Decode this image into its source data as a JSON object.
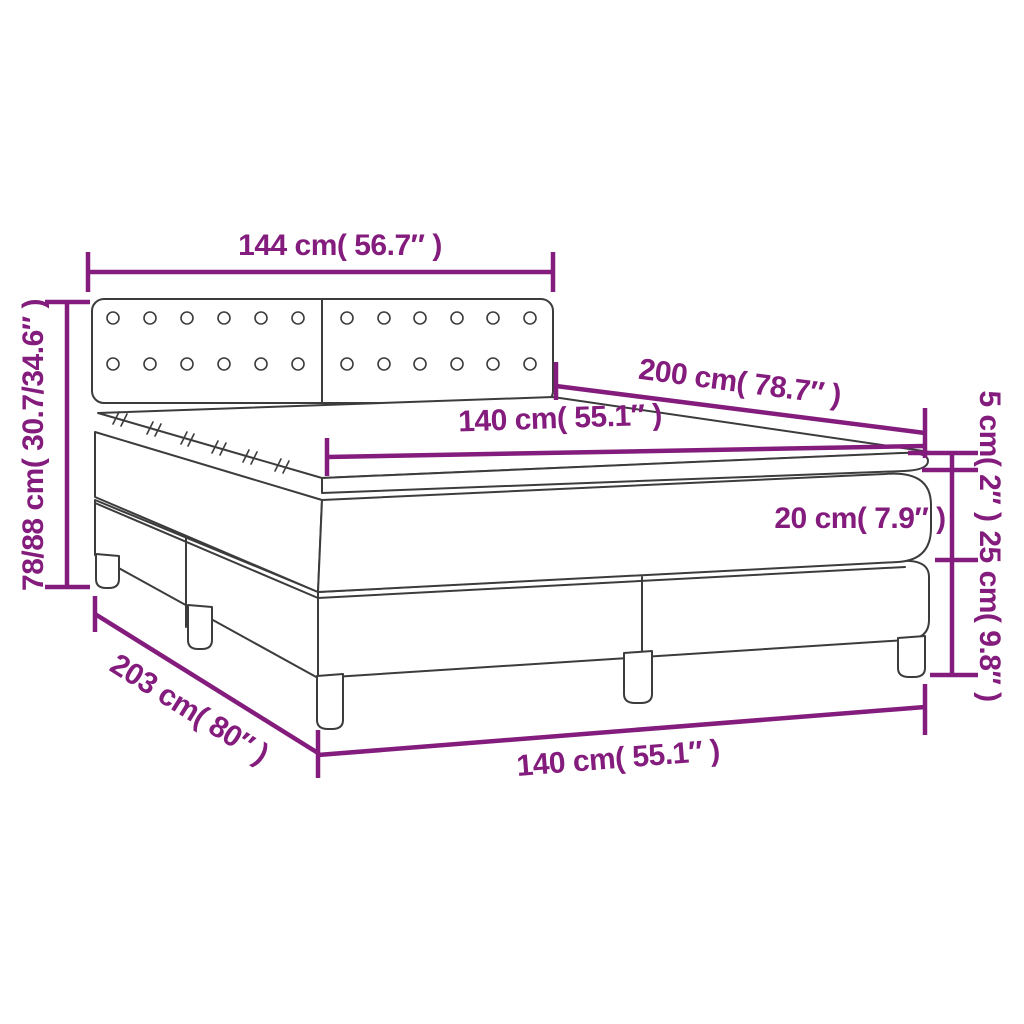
{
  "diagram": {
    "subject": "box-spring-bed-with-topper-dimension-diagram",
    "colors": {
      "dimension": "#831c7c",
      "outline": "#3c3c3c",
      "background": "#ffffff"
    },
    "dimensions": {
      "headboard_width": {
        "label": "144 cm( 56.7″ )"
      },
      "total_height": {
        "label": "78/88 cm( 30.7/34.6″ )"
      },
      "mattress_length": {
        "label": "200 cm( 78.7″ )"
      },
      "mattress_width_top": {
        "label": "140 cm( 55.1″ )"
      },
      "topper_height": {
        "label": "5 cm( 2″ )"
      },
      "mattress_height": {
        "label": "20 cm( 7.9″ )"
      },
      "base_height": {
        "label": "25 cm( 9.8″ )"
      },
      "total_length": {
        "label": "203 cm( 80″ )"
      },
      "bed_width_bottom": {
        "label": "140 cm( 55.1″ )"
      }
    }
  }
}
